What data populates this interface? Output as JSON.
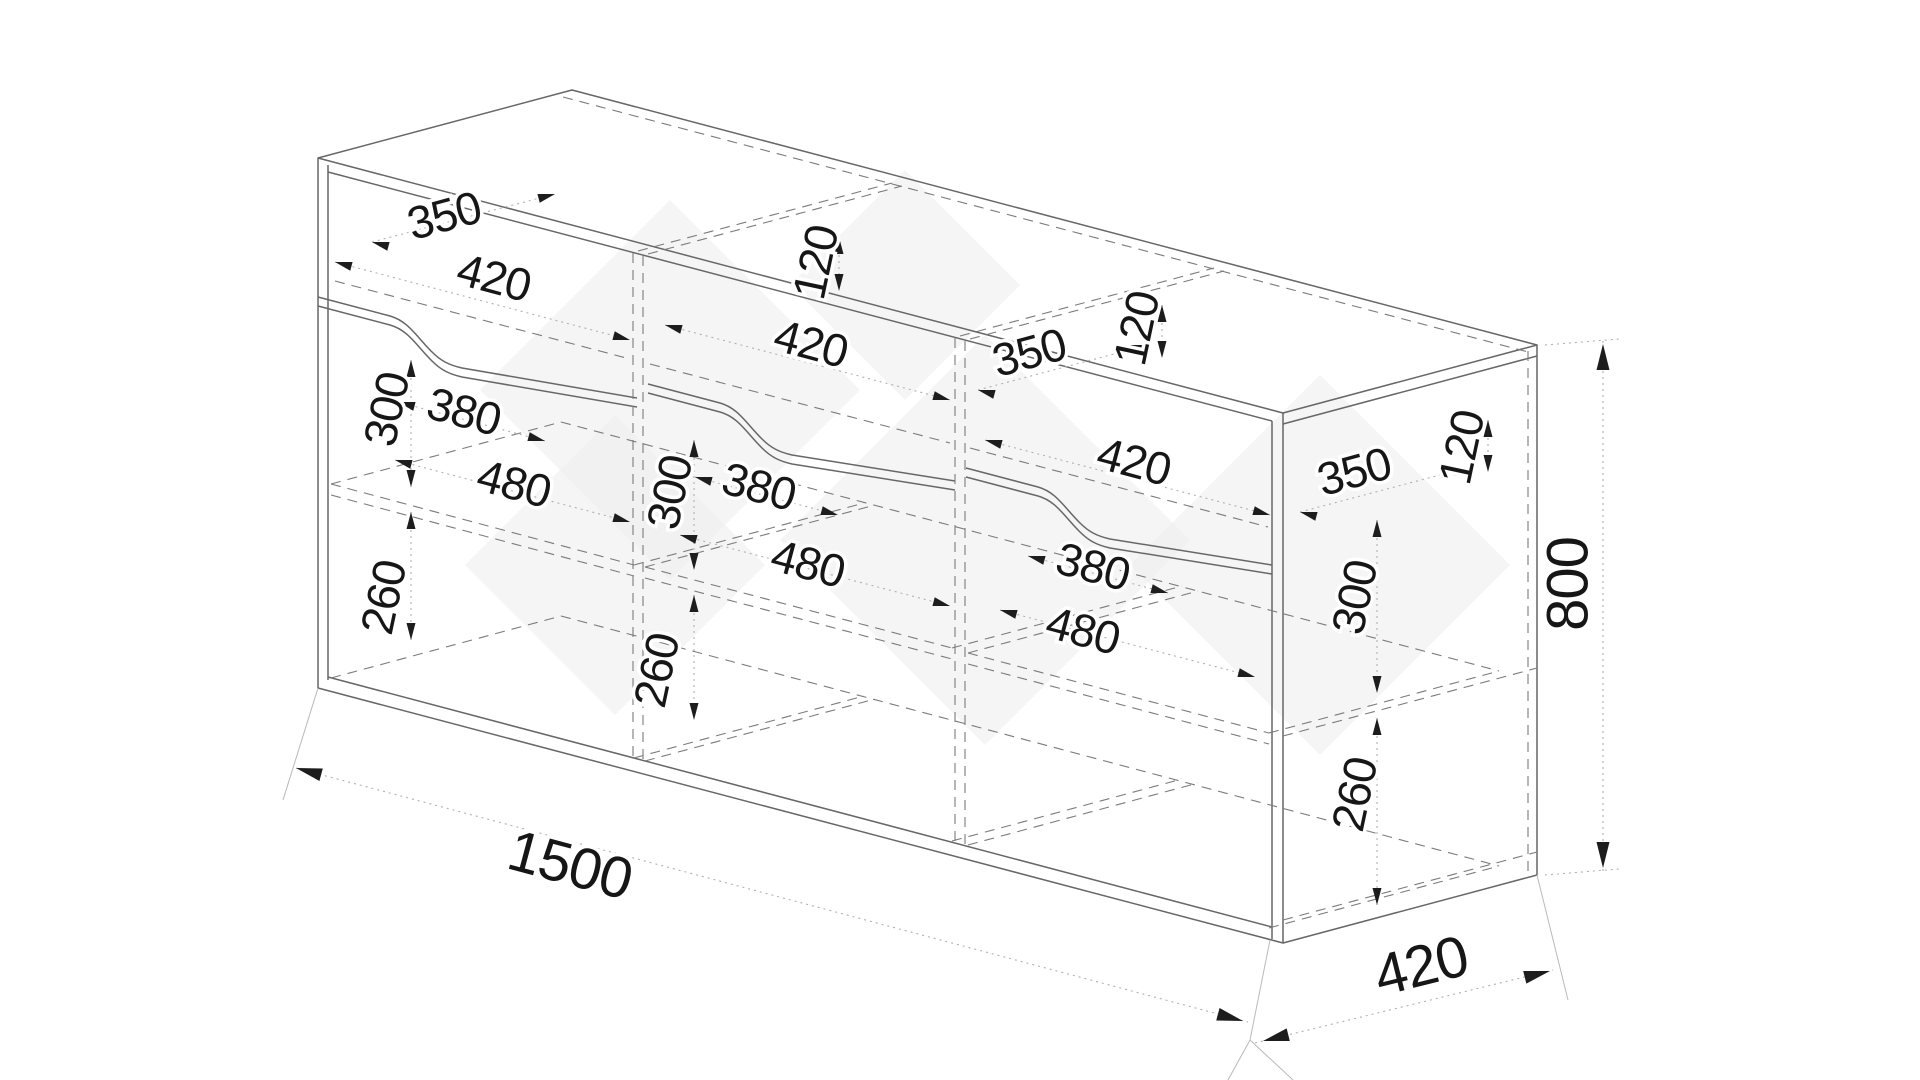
{
  "page": {
    "background": "#ffffff"
  },
  "drawing": {
    "kind": "isometric-furniture-dimension-drawing",
    "object": "three-section sideboard with top drawers and shelved compartments",
    "overall": {
      "width_label": "1500",
      "depth_label": "420",
      "height_label": "800"
    },
    "colors": {
      "solid_line": "#676767",
      "dashed_line": "#7b7b7b",
      "dotted_line": "#b0b0b0",
      "extension_line": "#b9b9b9",
      "arrow": "#1d1d1d",
      "label": "#141414",
      "watermark": "#eeeeee"
    },
    "labels": [
      {
        "t": "350",
        "x": 445,
        "y": 219,
        "r": -15,
        "s": 46,
        "name": "drawer1-depth"
      },
      {
        "t": "420",
        "x": 493,
        "y": 281,
        "r": 15,
        "s": 46,
        "name": "drawer1-width"
      },
      {
        "t": "120",
        "x": 819,
        "y": 263,
        "r": -78,
        "s": 46,
        "name": "drawer2-height"
      },
      {
        "t": "420",
        "x": 810,
        "y": 347,
        "r": 15,
        "s": 46,
        "name": "drawer2-width"
      },
      {
        "t": "350",
        "x": 1030,
        "y": 356,
        "r": -15,
        "s": 46,
        "name": "drawer2-depth"
      },
      {
        "t": "120",
        "x": 1140,
        "y": 329,
        "r": -78,
        "s": 46,
        "name": "drawer3-height"
      },
      {
        "t": "420",
        "x": 1133,
        "y": 465,
        "r": 15,
        "s": 46,
        "name": "drawer3-width"
      },
      {
        "t": "350",
        "x": 1355,
        "y": 475,
        "r": -15,
        "s": 46,
        "name": "side-drawer-depth"
      },
      {
        "t": "120",
        "x": 1465,
        "y": 448,
        "r": -78,
        "s": 46,
        "name": "side-drawer-height"
      },
      {
        "t": "300",
        "x": 390,
        "y": 410,
        "r": -78,
        "s": 46,
        "name": "bay1-upper-height"
      },
      {
        "t": "380",
        "x": 463,
        "y": 415,
        "r": 15,
        "s": 46,
        "name": "bay1-shelf-depth"
      },
      {
        "t": "480",
        "x": 513,
        "y": 487,
        "r": 15,
        "s": 46,
        "name": "bay1-width"
      },
      {
        "t": "260",
        "x": 387,
        "y": 598,
        "r": -78,
        "s": 46,
        "name": "bay1-lower-height"
      },
      {
        "t": "300",
        "x": 673,
        "y": 493,
        "r": -78,
        "s": 46,
        "name": "bay2-upper-height"
      },
      {
        "t": "380",
        "x": 758,
        "y": 490,
        "r": 15,
        "s": 46,
        "name": "bay2-shelf-depth"
      },
      {
        "t": "480",
        "x": 807,
        "y": 567,
        "r": 15,
        "s": 46,
        "name": "bay2-width"
      },
      {
        "t": "260",
        "x": 660,
        "y": 671,
        "r": -78,
        "s": 46,
        "name": "bay2-lower-height"
      },
      {
        "t": "380",
        "x": 1092,
        "y": 570,
        "r": 15,
        "s": 46,
        "name": "bay3-shelf-depth"
      },
      {
        "t": "480",
        "x": 1082,
        "y": 634,
        "r": 15,
        "s": 46,
        "name": "bay3-width"
      },
      {
        "t": "300",
        "x": 1358,
        "y": 598,
        "r": -78,
        "s": 46,
        "name": "side-upper-height"
      },
      {
        "t": "260",
        "x": 1358,
        "y": 795,
        "r": -78,
        "s": 46,
        "name": "side-lower-height"
      },
      {
        "t": "1500",
        "x": 569,
        "y": 869,
        "r": 15,
        "s": 58,
        "name": "overall-width"
      },
      {
        "t": "420",
        "x": 1422,
        "y": 970,
        "r": -14,
        "s": 58,
        "name": "overall-depth"
      },
      {
        "t": "800",
        "x": 1572,
        "y": 584,
        "r": -90,
        "s": 58,
        "name": "overall-height"
      }
    ]
  }
}
